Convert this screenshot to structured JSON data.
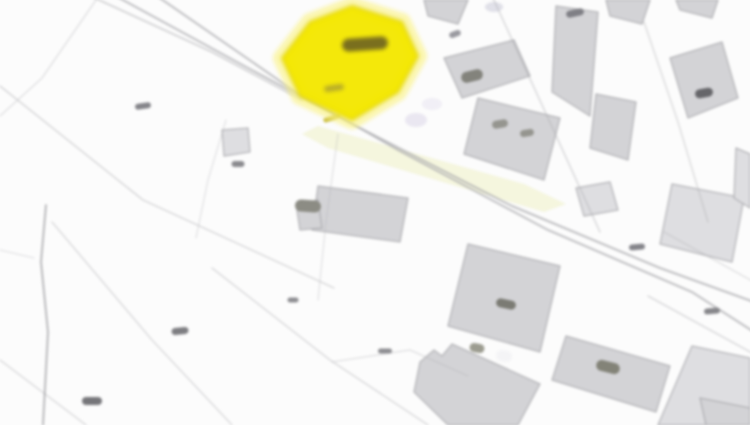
{
  "map": {
    "width": 750,
    "height": 425,
    "background": "#fcfcfc",
    "description": "Blurred cadastral parcel map extract with one parcel highlighted in yellow near the top centre; grey building footprints in a diagonal street grid occupy the upper-right and lower-right, faint parcel boundary lines cross the lower-left; all parcel-number labels are illegible smudges",
    "palette": {
      "building_fill": "#d3d3d6",
      "building_fill_light": "#dedee1",
      "building_stroke": "#a6a6aa",
      "parcel_line": "#b2b2b6",
      "road_line": "#a9a9ad",
      "stream_line": "#8f8f93",
      "highlight_fill": "#f4e800",
      "highlight_halo": "#faf27d",
      "highlight_edge": "#e0d200",
      "highlight_label": "#7a6f1e",
      "road_tint": "#eef0c4",
      "label_dark": "#6a6a6e"
    },
    "highlight_parcel": {
      "points": [
        [
          352,
          6
        ],
        [
          402,
          22
        ],
        [
          418,
          56
        ],
        [
          398,
          92
        ],
        [
          352,
          120
        ],
        [
          300,
          96
        ],
        [
          282,
          58
        ],
        [
          310,
          22
        ]
      ],
      "label_smudge": {
        "x": 365,
        "y": 44,
        "w": 46,
        "h": 13,
        "angle": -4
      },
      "sub_smudge": {
        "x": 334,
        "y": 88,
        "w": 20,
        "h": 6,
        "angle": -8
      }
    },
    "roads": [
      {
        "points": [
          [
            86,
            -6
          ],
          [
            212,
            52
          ],
          [
            302,
            100
          ]
        ],
        "width": 1.6,
        "opacity": 0.55
      },
      {
        "points": [
          [
            112,
            -6
          ],
          [
            248,
            68
          ],
          [
            356,
            126
          ],
          [
            512,
            206
          ],
          [
            660,
            268
          ],
          [
            754,
            302
          ]
        ],
        "width": 1.8,
        "opacity": 0.8
      },
      {
        "points": [
          [
            154,
            -6
          ],
          [
            290,
            88
          ],
          [
            398,
            150
          ],
          [
            548,
            230
          ],
          [
            692,
            292
          ],
          [
            754,
            332
          ]
        ],
        "width": 1.8,
        "opacity": 0.8
      },
      {
        "points": [
          [
            492,
            -4
          ],
          [
            548,
            118
          ],
          [
            600,
            232
          ]
        ],
        "width": 1.4,
        "opacity": 0.45
      },
      {
        "points": [
          [
            644,
            22
          ],
          [
            678,
            122
          ],
          [
            708,
            222
          ]
        ],
        "width": 1.4,
        "opacity": 0.4
      },
      {
        "points": [
          [
            648,
            296
          ],
          [
            754,
            354
          ]
        ],
        "width": 1.4,
        "opacity": 0.45
      },
      {
        "points": [
          [
            664,
            232
          ],
          [
            754,
            282
          ]
        ],
        "width": 1.2,
        "opacity": 0.4
      }
    ],
    "parcel_lines": [
      {
        "points": [
          [
            0,
            86
          ],
          [
            143,
            200
          ],
          [
            256,
            252
          ],
          [
            334,
            288
          ]
        ],
        "width": 1.2,
        "opacity": 0.6
      },
      {
        "points": [
          [
            52,
            222
          ],
          [
            152,
            340
          ],
          [
            232,
            425
          ]
        ],
        "width": 1.2,
        "opacity": 0.55
      },
      {
        "points": [
          [
            0,
            360
          ],
          [
            86,
            425
          ]
        ],
        "width": 1.2,
        "opacity": 0.5
      },
      {
        "points": [
          [
            212,
            268
          ],
          [
            330,
            360
          ],
          [
            428,
            425
          ]
        ],
        "width": 1.2,
        "opacity": 0.55
      },
      {
        "points": [
          [
            332,
            362
          ],
          [
            410,
            350
          ],
          [
            468,
            376
          ]
        ],
        "width": 1.1,
        "opacity": 0.45
      },
      {
        "points": [
          [
            96,
            0
          ],
          [
            42,
            78
          ],
          [
            0,
            116
          ]
        ],
        "width": 1.1,
        "opacity": 0.45
      },
      {
        "points": [
          [
            338,
            134
          ],
          [
            326,
            222
          ],
          [
            318,
            300
          ]
        ],
        "width": 1.1,
        "opacity": 0.4
      },
      {
        "points": [
          [
            46,
            205
          ],
          [
            41,
            262
          ],
          [
            48,
            332
          ],
          [
            43,
            425
          ]
        ],
        "width": 1.6,
        "opacity": 0.75,
        "color": "#8f8f93"
      },
      {
        "points": [
          [
            0,
            250
          ],
          [
            34,
            258
          ]
        ],
        "width": 1.1,
        "opacity": 0.4
      },
      {
        "points": [
          [
            226,
            120
          ],
          [
            208,
            180
          ],
          [
            196,
            238
          ]
        ],
        "width": 1.1,
        "opacity": 0.4
      }
    ],
    "road_tint_band": [
      [
        318,
        126
      ],
      [
        524,
        184
      ],
      [
        566,
        204
      ],
      [
        544,
        212
      ],
      [
        328,
        148
      ],
      [
        302,
        134
      ]
    ],
    "buildings": [
      {
        "points": [
          [
            424,
            0
          ],
          [
            468,
            0
          ],
          [
            458,
            24
          ],
          [
            428,
            16
          ]
        ]
      },
      {
        "points": [
          [
            444,
            58
          ],
          [
            514,
            40
          ],
          [
            530,
            76
          ],
          [
            462,
            98
          ]
        ]
      },
      {
        "points": [
          [
            556,
            6
          ],
          [
            598,
            12
          ],
          [
            590,
            116
          ],
          [
            552,
            92
          ]
        ]
      },
      {
        "points": [
          [
            606,
            0
          ],
          [
            650,
            0
          ],
          [
            642,
            24
          ],
          [
            610,
            16
          ]
        ]
      },
      {
        "points": [
          [
            676,
            0
          ],
          [
            718,
            0
          ],
          [
            712,
            18
          ],
          [
            680,
            10
          ]
        ]
      },
      {
        "points": [
          [
            670,
            58
          ],
          [
            722,
            42
          ],
          [
            738,
            98
          ],
          [
            688,
            118
          ]
        ]
      },
      {
        "points": [
          [
            596,
            94
          ],
          [
            636,
            102
          ],
          [
            628,
            160
          ],
          [
            590,
            148
          ]
        ]
      },
      {
        "points": [
          [
            478,
            98
          ],
          [
            560,
            118
          ],
          [
            544,
            180
          ],
          [
            464,
            154
          ]
        ]
      },
      {
        "points": [
          [
            672,
            184
          ],
          [
            744,
            198
          ],
          [
            732,
            262
          ],
          [
            660,
            244
          ]
        ],
        "light": true
      },
      {
        "points": [
          [
            576,
            188
          ],
          [
            610,
            182
          ],
          [
            618,
            210
          ],
          [
            584,
            216
          ]
        ],
        "light": true
      },
      {
        "points": [
          [
            318,
            186
          ],
          [
            408,
            198
          ],
          [
            400,
            242
          ],
          [
            312,
            230
          ]
        ]
      },
      {
        "points": [
          [
            296,
            204
          ],
          [
            318,
            200
          ],
          [
            322,
            228
          ],
          [
            300,
            230
          ]
        ]
      },
      {
        "points": [
          [
            222,
            130
          ],
          [
            248,
            128
          ],
          [
            250,
            152
          ],
          [
            224,
            156
          ]
        ],
        "light": true
      },
      {
        "points": [
          [
            468,
            244
          ],
          [
            560,
            266
          ],
          [
            540,
            352
          ],
          [
            448,
            326
          ]
        ]
      },
      {
        "points": [
          [
            566,
            336
          ],
          [
            670,
            366
          ],
          [
            656,
            412
          ],
          [
            552,
            380
          ]
        ]
      },
      {
        "points": [
          [
            420,
            362
          ],
          [
            434,
            350
          ],
          [
            442,
            356
          ],
          [
            452,
            344
          ],
          [
            540,
            384
          ],
          [
            518,
            425
          ],
          [
            448,
            425
          ],
          [
            414,
            392
          ]
        ]
      },
      {
        "points": [
          [
            692,
            346
          ],
          [
            750,
            358
          ],
          [
            750,
            425
          ],
          [
            658,
            425
          ]
        ],
        "light": true
      },
      {
        "points": [
          [
            700,
            398
          ],
          [
            750,
            408
          ],
          [
            750,
            425
          ],
          [
            706,
            425
          ]
        ]
      },
      {
        "points": [
          [
            736,
            148
          ],
          [
            750,
            154
          ],
          [
            750,
            208
          ],
          [
            734,
            198
          ]
        ],
        "light": true
      }
    ],
    "smudges": [
      {
        "x": 143,
        "y": 106,
        "w": 16,
        "h": 6,
        "angle": -8,
        "color": "#85858a"
      },
      {
        "x": 238,
        "y": 164,
        "w": 13,
        "h": 6,
        "angle": 0,
        "color": "#8a8a8e"
      },
      {
        "x": 180,
        "y": 331,
        "w": 17,
        "h": 7,
        "angle": -6,
        "color": "#7e7e82"
      },
      {
        "x": 92,
        "y": 401,
        "w": 20,
        "h": 8,
        "angle": 0,
        "color": "#76767a"
      },
      {
        "x": 293,
        "y": 300,
        "w": 11,
        "h": 5,
        "angle": 0,
        "color": "#8e8e92"
      },
      {
        "x": 385,
        "y": 351,
        "w": 14,
        "h": 5,
        "angle": 0,
        "color": "#8e8e92"
      },
      {
        "x": 637,
        "y": 247,
        "w": 16,
        "h": 6,
        "angle": -5,
        "color": "#84848a"
      },
      {
        "x": 704,
        "y": 93,
        "w": 18,
        "h": 9,
        "angle": -10,
        "color": "#66666a"
      },
      {
        "x": 575,
        "y": 13,
        "w": 18,
        "h": 7,
        "angle": -12,
        "color": "#7f7f85"
      },
      {
        "x": 455,
        "y": 34,
        "w": 12,
        "h": 6,
        "angle": -20,
        "color": "#9a9aa0"
      },
      {
        "x": 712,
        "y": 311,
        "w": 16,
        "h": 6,
        "angle": -5,
        "color": "#87878b"
      },
      {
        "x": 472,
        "y": 76,
        "w": 22,
        "h": 11,
        "angle": -14,
        "color": "#83837c"
      },
      {
        "x": 500,
        "y": 124,
        "w": 16,
        "h": 8,
        "angle": -10,
        "color": "#95958f"
      },
      {
        "x": 527,
        "y": 133,
        "w": 14,
        "h": 7,
        "angle": -10,
        "color": "#95958f"
      },
      {
        "x": 506,
        "y": 304,
        "w": 20,
        "h": 9,
        "angle": 12,
        "color": "#7b7b74"
      },
      {
        "x": 308,
        "y": 206,
        "w": 26,
        "h": 12,
        "angle": 4,
        "color": "#8c8c84"
      },
      {
        "x": 477,
        "y": 348,
        "w": 15,
        "h": 9,
        "angle": 10,
        "color": "#9c9c90"
      },
      {
        "x": 504,
        "y": 356,
        "w": 16,
        "h": 11,
        "angle": 10,
        "color": "#f4f4f6"
      },
      {
        "x": 608,
        "y": 367,
        "w": 24,
        "h": 11,
        "angle": 14,
        "color": "#838378"
      },
      {
        "x": 332,
        "y": 118,
        "w": 18,
        "h": 5,
        "angle": -18,
        "color": "#cfc34a"
      }
    ],
    "tint_blobs": [
      {
        "x": 416,
        "y": 120,
        "rx": 11,
        "ry": 7,
        "color": "#cfc8e2",
        "opacity": 0.4
      },
      {
        "x": 494,
        "y": 7,
        "rx": 9,
        "ry": 5,
        "color": "#c6c6d6",
        "opacity": 0.5
      },
      {
        "x": 432,
        "y": 104,
        "rx": 10,
        "ry": 6,
        "color": "#d8d2e8",
        "opacity": 0.3
      }
    ]
  }
}
